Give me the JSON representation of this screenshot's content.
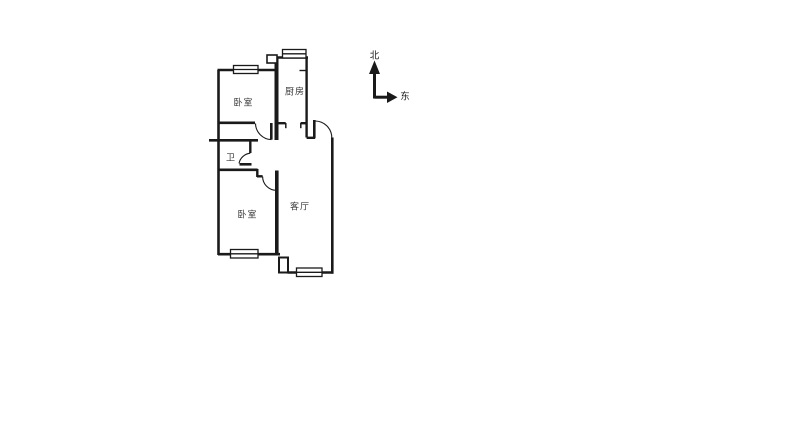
{
  "canvas": {
    "background_color": "#ffffff",
    "wall_color": "#1a1a1a",
    "label_color": "#3a3a3a"
  },
  "floor_plan": {
    "rooms": {
      "bedroom_top": {
        "label": "卧室"
      },
      "kitchen": {
        "label": "厨房"
      },
      "bathroom": {
        "label": "卫"
      },
      "bedroom_bottom": {
        "label": "卧室"
      },
      "living_room": {
        "label": "客厅"
      }
    }
  },
  "compass": {
    "north_label": "北",
    "east_label": "东"
  }
}
